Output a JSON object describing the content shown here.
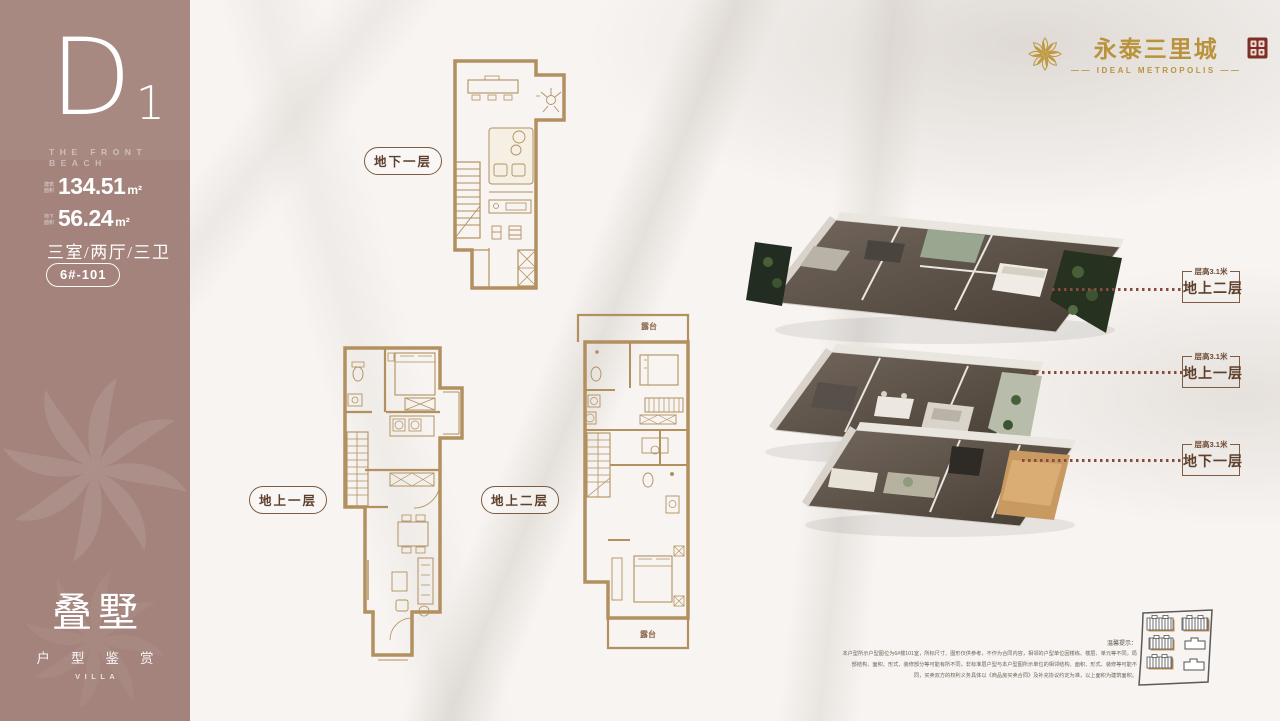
{
  "brand": {
    "title": "永泰三里城",
    "subtitle": "IDEAL METROPOLIS",
    "flower_icon": "gold-lotus-flower",
    "seal_icon": "red-seal-stamp"
  },
  "sidebar": {
    "unit_letter": "D",
    "unit_number": "1",
    "tagline_line1": "THE FRONT",
    "tagline_line2": "BEACH",
    "areas": [
      {
        "label": "建筑面积",
        "value": "134.51",
        "unit": "m²"
      },
      {
        "label": "地下面积",
        "value": "56.24",
        "unit": "m²"
      }
    ],
    "rooms": "三室/两厅/三卫",
    "unit_no": "6#-101",
    "product_title": "叠墅",
    "product_subtitle": "户型鉴赏",
    "product_en": "VILLA"
  },
  "plans": {
    "basement_label": "地下一层",
    "floor1_label": "地上一层",
    "floor2_label": "地上二层",
    "balcony_top": "露台",
    "balcony_bottom": "露台"
  },
  "floor_tags": [
    {
      "height": "层高3.1米",
      "name": "地上二层"
    },
    {
      "height": "层高3.1米",
      "name": "地上一层"
    },
    {
      "height": "层高3.1米",
      "name": "地下一层"
    }
  ],
  "disclaimer": {
    "title": "温馨提示：",
    "lines": [
      "本户型所示户型图位为6#楼101室，所标尺寸、图形仅供参考，不作为合同内容，相邻的户型单位因楼栋、楼层、单元等不同，局",
      "部结构、面积、形式、装修部分等可能有所不同，非标准层户型与本户型图所示单位的相邻结构、面积、形式、装修等可能不",
      "同，买卖双方的权利义务具体以《商品房买卖合同》及补充协议约定为准，以上面积为建筑面积。"
    ]
  },
  "colors": {
    "sidebar": "#a3837c",
    "plan_gold": "#b2905f",
    "brand_gold": "#bb9440",
    "label_brown": "#5e3f2c",
    "dot_line": "#8a4a3c",
    "seal_red": "#7e2f23",
    "background": "#f7f4f1"
  }
}
